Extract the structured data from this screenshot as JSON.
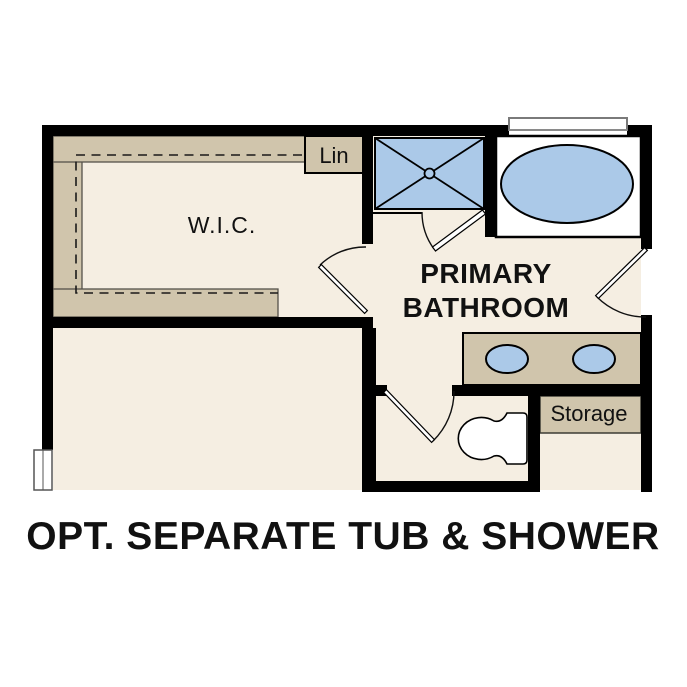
{
  "title": "OPT. SEPARATE TUB & SHOWER",
  "plan": {
    "rooms": {
      "wic_label": "W.I.C.",
      "lin_label": "Lin",
      "bathroom_label_line1": "PRIMARY",
      "bathroom_label_line2": "BATHROOM",
      "storage_label": "Storage"
    },
    "colors": {
      "wall": "#000000",
      "floor": "#f5eee2",
      "casework": "#d0c5ac",
      "fixture_blue": "#abc9e8",
      "fixture_white": "#ffffff",
      "window_frame": "#7a7a7a",
      "label_text": "#111111"
    },
    "fixtures": [
      "shower",
      "bathtub",
      "vanity-double-sink",
      "toilet"
    ]
  }
}
